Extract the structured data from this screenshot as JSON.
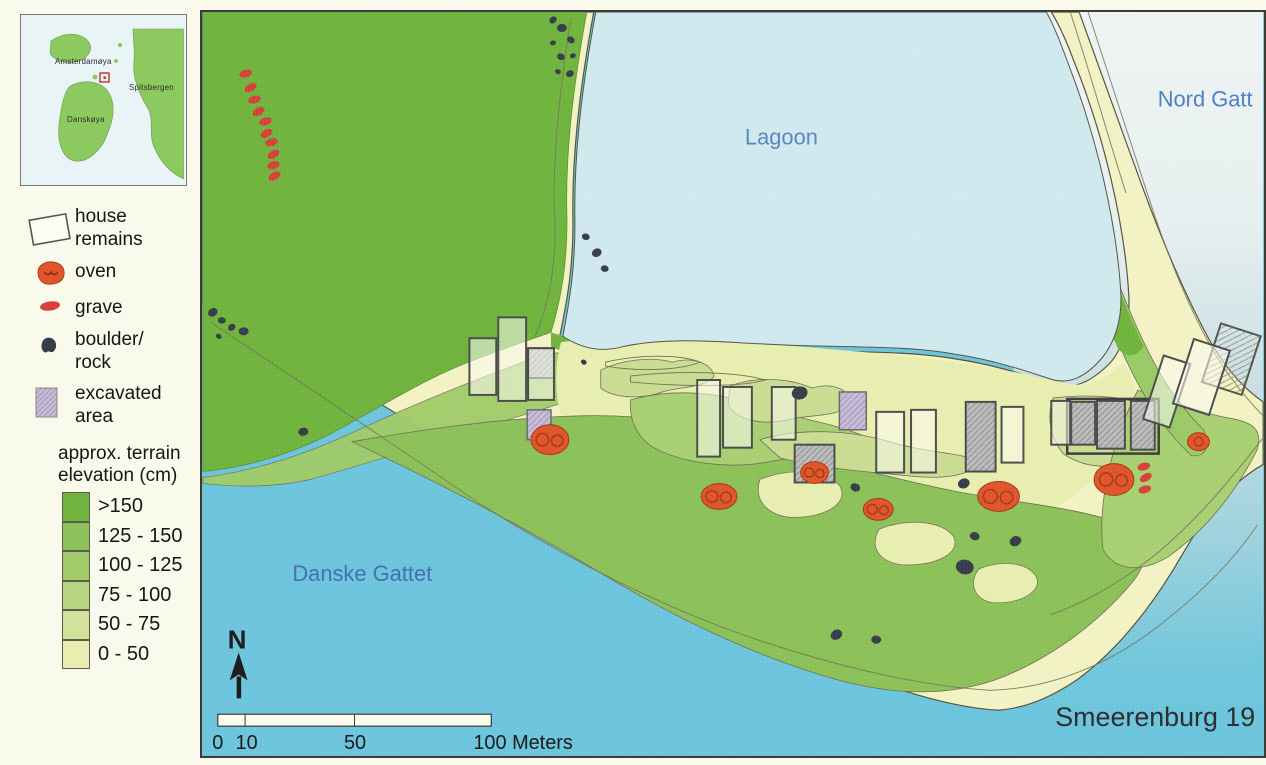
{
  "inset": {
    "labels": {
      "amsterdamoya": "Amsterdamøya",
      "spitsbergen": "Spitsbergen",
      "danskoya": "Danskøya"
    }
  },
  "legend": {
    "items": [
      {
        "id": "house-remains",
        "label": "house\nremains"
      },
      {
        "id": "oven",
        "label": "oven"
      },
      {
        "id": "grave",
        "label": "grave"
      },
      {
        "id": "boulder-rock",
        "label": "boulder/\nrock"
      },
      {
        "id": "excavated-area",
        "label": "excavated\narea"
      }
    ]
  },
  "elevation": {
    "title": "approx. terrain\nelevation (cm)",
    "classes": [
      {
        "label": ">150",
        "color": "#70b43e"
      },
      {
        "label": "125 - 150",
        "color": "#8cc159"
      },
      {
        "label": "100 - 125",
        "color": "#a0cb68"
      },
      {
        "label": "75 - 100",
        "color": "#b8d682"
      },
      {
        "label": "50 - 75",
        "color": "#d2e29c"
      },
      {
        "label": "0 - 50",
        "color": "#e9edb2"
      }
    ]
  },
  "map": {
    "labels": {
      "lagoon": "Lagoon",
      "nord_gattet": "Nord Gatt",
      "danske_gattet": "Danske Gattet",
      "title": "Smeerenburg 19"
    },
    "north_label": "N",
    "scalebar": {
      "tick_0": "0",
      "tick_10": "10",
      "tick_50": "50",
      "tick_100": "100 Meters"
    },
    "colors": {
      "sea": "#6cc5dc",
      "lagoon": "#cfe9ef",
      "nord_water": "#eff4f2",
      "beach": "#f2f2c4",
      "flat": "#e8edb0",
      "house_fill": "#fcfcf2",
      "house_stroke": "#4c4c4c",
      "oven": "#e0552a",
      "grave": "#d8403a",
      "boulder": "#373e4b",
      "excavated_gray": "#bcbcbc",
      "excavated_lavender": "#c6bdd6",
      "water_label_blue": "#4d82c4"
    },
    "features": {
      "houses": [
        [
          268,
          328,
          27,
          57,
          0
        ],
        [
          297,
          307,
          28,
          84,
          0
        ],
        [
          327,
          338,
          26,
          52,
          0
        ],
        [
          497,
          370,
          23,
          77,
          0
        ],
        [
          523,
          377,
          29,
          61,
          0
        ],
        [
          572,
          377,
          24,
          53,
          0
        ],
        [
          677,
          402,
          28,
          61,
          0
        ],
        [
          712,
          400,
          25,
          63,
          0
        ],
        [
          803,
          397,
          22,
          56,
          0
        ],
        [
          853,
          391,
          19,
          44,
          0
        ],
        [
          955,
          348,
          28,
          67,
          18
        ],
        [
          985,
          333,
          38,
          68,
          18
        ]
      ],
      "excavated": [
        [
          327,
          338,
          26,
          30,
          0,
          "gray"
        ],
        [
          326,
          400,
          24,
          30,
          0,
          "lavender"
        ],
        [
          640,
          382,
          27,
          38,
          0,
          "lavender"
        ],
        [
          767,
          392,
          30,
          70,
          0,
          "gray"
        ],
        [
          873,
          392,
          24,
          43,
          0,
          "gray"
        ],
        [
          899,
          391,
          28,
          48,
          0,
          "gray"
        ],
        [
          933,
          391,
          24,
          49,
          0,
          "gray"
        ],
        [
          595,
          435,
          40,
          38,
          0,
          "gray"
        ],
        [
          1013,
          318,
          42,
          62,
          18,
          "hatch-frame"
        ],
        [
          869,
          389,
          92,
          55,
          0,
          "frame"
        ]
      ],
      "ovens": [
        [
          349,
          430,
          19,
          15
        ],
        [
          519,
          487,
          18,
          13
        ],
        [
          615,
          463,
          14,
          11
        ],
        [
          679,
          500,
          15,
          11
        ],
        [
          800,
          487,
          21,
          15
        ],
        [
          916,
          470,
          20,
          16
        ],
        [
          1001,
          432,
          11,
          9
        ]
      ],
      "graves": [
        [
          43,
          62
        ],
        [
          48,
          76
        ],
        [
          52,
          88
        ],
        [
          56,
          100
        ],
        [
          63,
          110
        ],
        [
          64,
          122
        ],
        [
          69,
          131
        ],
        [
          71,
          143
        ],
        [
          71,
          154
        ],
        [
          72,
          165
        ],
        [
          946,
          457
        ],
        [
          948,
          468
        ],
        [
          947,
          480
        ]
      ],
      "boulders": [
        [
          352,
          8,
          4
        ],
        [
          361,
          16,
          5
        ],
        [
          370,
          28,
          4
        ],
        [
          352,
          31,
          3
        ],
        [
          360,
          45,
          4
        ],
        [
          372,
          44,
          3
        ],
        [
          357,
          60,
          3
        ],
        [
          369,
          62,
          4
        ],
        [
          385,
          226,
          4
        ],
        [
          396,
          242,
          5
        ],
        [
          404,
          258,
          4
        ],
        [
          10,
          302,
          5
        ],
        [
          19,
          310,
          4
        ],
        [
          29,
          317,
          4
        ],
        [
          41,
          321,
          5
        ],
        [
          16,
          326,
          3
        ],
        [
          101,
          422,
          5
        ],
        [
          383,
          352,
          3
        ],
        [
          600,
          383,
          8
        ],
        [
          656,
          478,
          5
        ],
        [
          765,
          474,
          6
        ],
        [
          776,
          527,
          5
        ],
        [
          817,
          532,
          6
        ],
        [
          766,
          558,
          9
        ],
        [
          637,
          626,
          6
        ],
        [
          677,
          631,
          5
        ]
      ]
    }
  }
}
